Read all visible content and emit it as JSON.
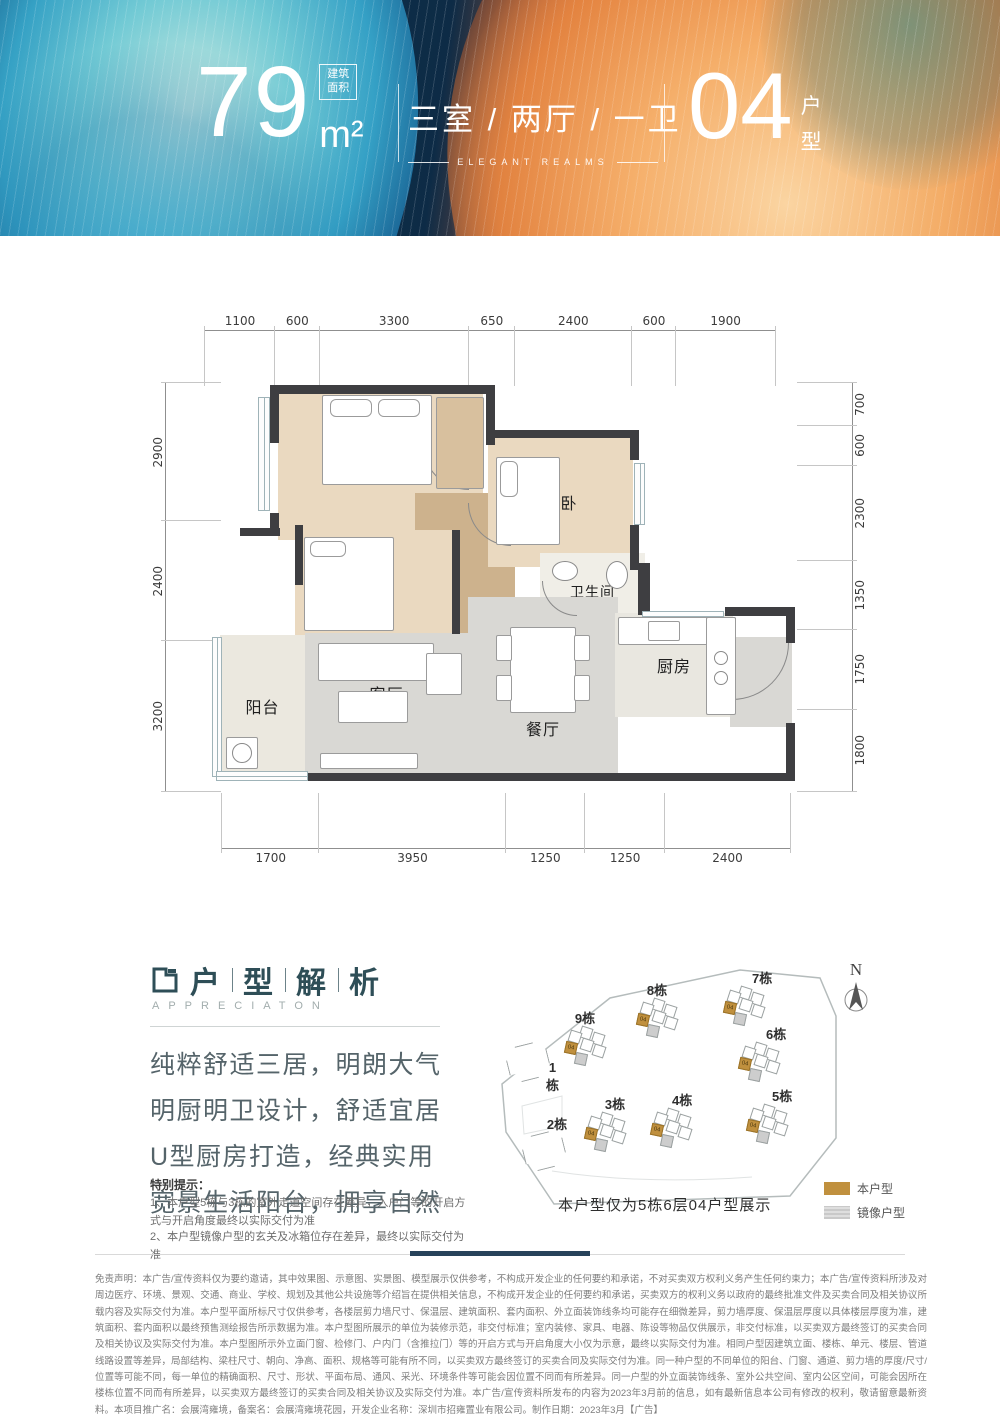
{
  "header": {
    "area_value": "79",
    "area_badge_line1": "建筑",
    "area_badge_line2": "面积",
    "area_unit": "m²",
    "rooms_title": "三室 / 两厅 / 一卫",
    "rooms_subtitle": "ELEGANT REALMS",
    "unit_value": "04",
    "unit_char1": "户",
    "unit_char2": "型"
  },
  "floorplan": {
    "dims_top": [
      "1100",
      "600",
      "3300",
      "650",
      "2400",
      "600",
      "1900"
    ],
    "dims_left": [
      "2900",
      "2400",
      "3200"
    ],
    "dims_right": [
      "700",
      "600",
      "2300",
      "1350",
      "1750",
      "1800"
    ],
    "dims_bottom": [
      "1700",
      "3950",
      "1250",
      "1250",
      "2400"
    ],
    "room_master": "主卧",
    "room_second_top": "次卧",
    "room_second_mid": "次卧",
    "room_bath": "卫生间",
    "room_balcony": "阳台",
    "room_living": "客厅",
    "room_dining": "餐厅",
    "room_kitchen": "厨房"
  },
  "analysis": {
    "title_char1": "户",
    "title_char2": "型",
    "title_char3": "解",
    "title_char4": "析",
    "subtitle": "APPRECIATON",
    "line1": "纯粹舒适三居，明朗大气",
    "line2": "明厨明卫设计，舒适宜居",
    "line3": "U型厨房打造，经典实用",
    "line4": "宽景生活阳台，拥享自然",
    "note_title": "特别提示：",
    "note1": "1、本户型5栋与3栋的室外走道空间存在差异，入户门等的开启方式与开启角度最终以实际交付为准",
    "note2": "2、本户型镜像户型的玄关及冰箱位存在差异，最终以实际交付为准"
  },
  "sitemap": {
    "north": "N",
    "caption": "本户型仅为5栋6层04户型展示",
    "unit_tag": "04",
    "legend_this": "本户型",
    "legend_mirror": "镜像户型",
    "colors": {
      "this": "#c0903e",
      "mirror": "#c9c9c9"
    },
    "buildings": [
      {
        "label": "1栋"
      },
      {
        "label": "2栋"
      },
      {
        "label": "3栋"
      },
      {
        "label": "4栋"
      },
      {
        "label": "5栋"
      },
      {
        "label": "6栋"
      },
      {
        "label": "7栋"
      },
      {
        "label": "8栋"
      },
      {
        "label": "9栋"
      }
    ]
  },
  "disclaimer": "免责声明：本广告/宣传资料仅为要约邀请，其中效果图、示意图、实景图、模型展示仅供参考，不构成开发企业的任何要约和承诺，不对买卖双方权利义务产生任何约束力；本广告/宣传资料所涉及对周边医疗、环境、景观、交通、商业、学校、规划及其他公共设施等介绍旨在提供相关信息，不构成开发企业的任何要约和承诺，买卖双方的权利义务以政府的最终批准文件及买卖合同及相关协议所载内容及实际交付为准。本户型平面所标尺寸仅供参考，各楼层剪力墙尺寸、保温层、建筑面积、套内面积、外立面装饰线条均可能存在细微差异，剪力墙厚度、保温层厚度以具体楼层厚度为准，建筑面积、套内面积以最终预售测绘报告所示数据为准。本户型图所展示的单位为装修示范，非交付标准；室内装修、家具、电器、陈设等物品仅供展示，非交付标准，以买卖双方最终签订的买卖合同及相关协议及实际交付为准。本户型图所示外立面门窗、检修门、户内门（含推拉门）等的开启方式与开启角度大小仅为示意，最终以实际交付为准。相同户型因建筑立面、楼栋、单元、楼层、管道线路设置等差异，局部结构、梁柱尺寸、朝向、净高、面积、规格等可能有所不同，以买卖双方最终签订的买卖合同及实际交付为准。同一种户型的不同单位的阳台、门窗、通道、剪力墙的厚度/尺寸/位置等可能不同，每一单位的精确面积、尺寸、形状、平面布局、通风、采光、环境条件等可能会因位置不同而有所差异。同一户型的外立面装饰线条、室外公共空间、室内公区空间，可能会因所在楼栋位置不同而有所差异，以买卖双方最终签订的买卖合同及相关协议及实际交付为准。本广告/宣传资料所发布的内容为2023年3月前的信息，如有最新信息本公司有修改的权利，敬请留意最新资料。本项目推广名：会展湾雍境，备案名：会展湾雍境花园，开发企业名称：深圳市招雍置业有限公司。制作日期：2023年3月【广告】"
}
